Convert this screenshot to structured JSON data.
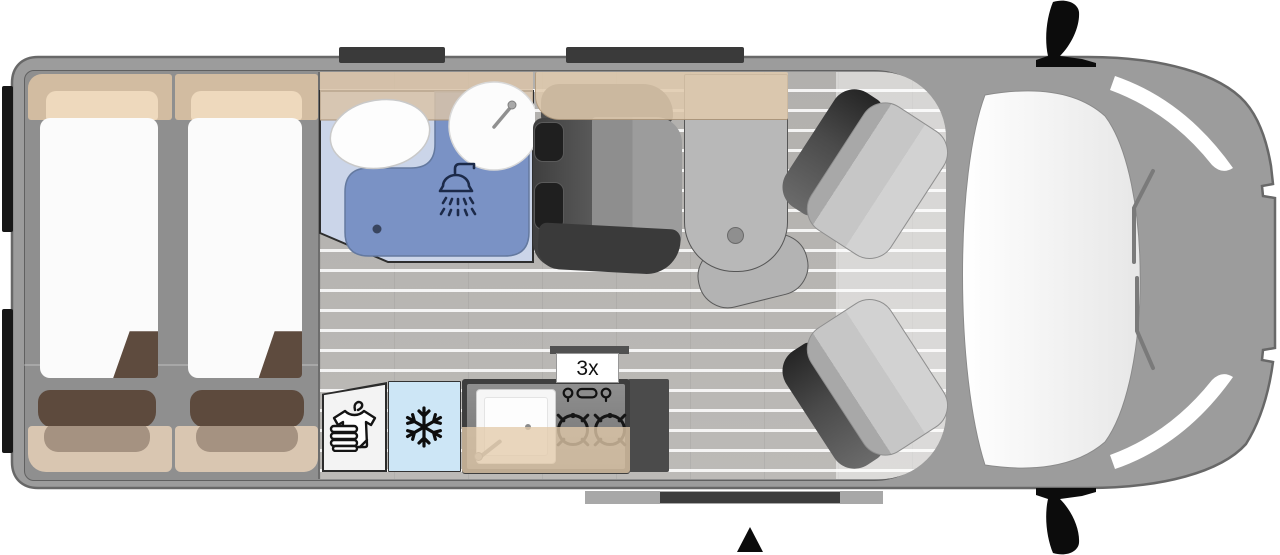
{
  "floorplan": {
    "title": "campervan-floorplan-top-view",
    "labels": {
      "burners": "3x"
    },
    "areas": {
      "bedroom": {
        "beds": 2
      },
      "bathroom": {
        "fixtures": [
          "toilet",
          "washbasin",
          "shower"
        ],
        "icons": [
          "shower-head-icon",
          "faucet-icon"
        ]
      },
      "wardrobe": {
        "icon": "shirt-hanger-icon"
      },
      "fridge": {
        "icon": "snowflake-icon"
      },
      "kitchen": {
        "icons": [
          "control-knobs-icon",
          "gas-burner-icon",
          "gas-burner-icon",
          "faucet-icon",
          "sink"
        ]
      },
      "lounge": {
        "bench_seats": 1,
        "tables": 1
      },
      "cab": {
        "swivel_seats": 2,
        "icons": [
          "mirror-icon",
          "mirror-icon",
          "wiper-icon"
        ]
      },
      "entrance": {
        "icon": "entry-arrow-icon"
      }
    },
    "colors": {
      "body_gray": "#9c9c9c",
      "outline_gray": "#686868",
      "floor_plank": "#b5b3b0",
      "cabinet_beige": "#d9c3a8",
      "pillow_beige": "#eed9bd",
      "mattress_white": "#fbfbfb",
      "blanket_brown": "#5d4a3d",
      "bath_floor_blue": "#cbd5e9",
      "shower_blue": "#7a92c5",
      "fridge_blue": "#cde6f6",
      "seat_dark": "#4a4a4a",
      "icon_black": "#111111",
      "shower_icon_navy": "#1c2a49"
    }
  }
}
